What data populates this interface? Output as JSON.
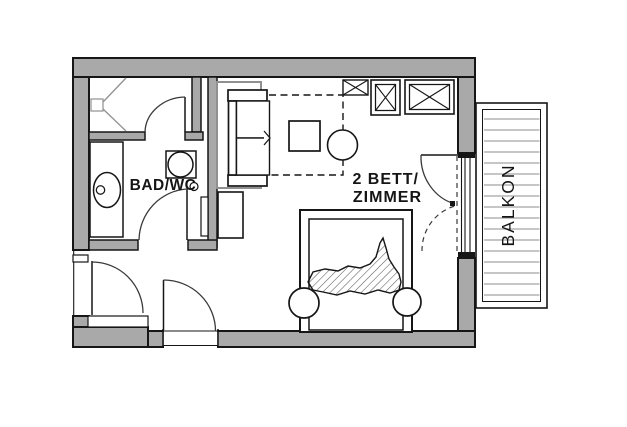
{
  "document": {
    "type": "floor-plan"
  },
  "colors": {
    "background": "#ffffff",
    "wall_fill": "#a9a9a9",
    "line": "#161616",
    "furniture_gray": "#909090",
    "plank_gray": "#b4b4b4",
    "hatch": "#5a5a5a"
  },
  "rooms": {
    "bathroom": {
      "label": "BAD/WC"
    },
    "bedroom": {
      "label_line1": "2 BETT/",
      "label_line2": "ZIMMER"
    },
    "balcony": {
      "label": "BALKON",
      "plank_count": 17,
      "plank_start_y": 119,
      "plank_spacing": 11
    }
  }
}
